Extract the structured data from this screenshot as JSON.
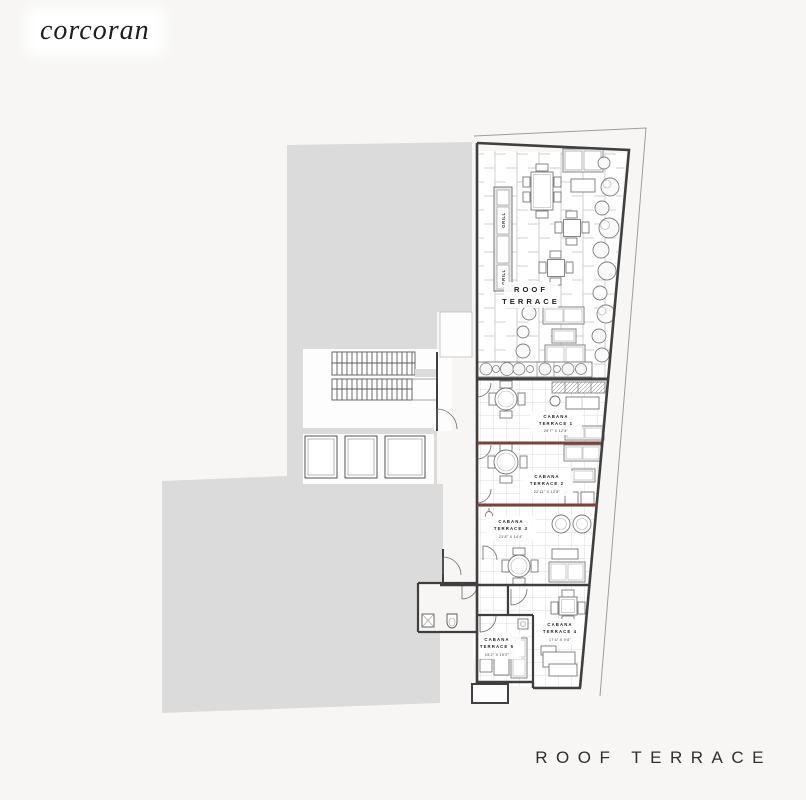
{
  "brand": {
    "logo_text": "corcoran"
  },
  "footer": {
    "title": "ROOF TERRACE"
  },
  "plan": {
    "main_label": {
      "line1": "ROOF",
      "line2": "TERRACE"
    },
    "grill_label": "GRILL",
    "rooms": [
      {
        "line1": "CABANA",
        "line2": "TERRACE 1",
        "dim": "25'7\" X 12'4\""
      },
      {
        "line1": "CABANA",
        "line2": "TERRACE 2",
        "dim": "22'11\" X 12'8\""
      },
      {
        "line1": "CABANA",
        "line2": "TERRACE 3",
        "dim": "21'8\" X 14'4\""
      },
      {
        "line1": "CABANA",
        "line2": "TERRACE 4",
        "dim": "17'4\" X 9'8\""
      },
      {
        "line1": "CABANA",
        "line2": "TERRACE 5",
        "dim": "15'2\" X 10'2\""
      }
    ],
    "colors": {
      "background": "#f7f6f5",
      "building_mass": "#dbdbdb",
      "wall": "#3f3f3f",
      "accent_wall": "#7a423a"
    }
  }
}
